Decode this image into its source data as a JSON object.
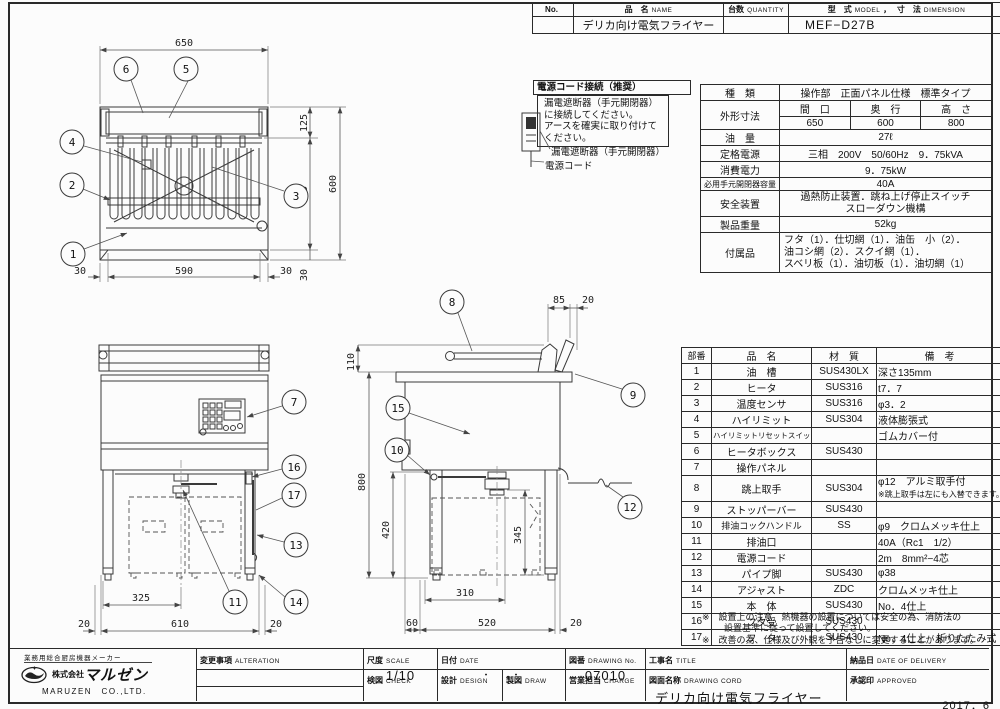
{
  "header_table": {
    "no_label": "No.",
    "name_jp": "品　名",
    "name_en": "NAME",
    "qty_jp": "台数",
    "qty_en": "QUANTITY",
    "model_jp": "型　式",
    "model_en": "MODEL",
    "comma": "，",
    "dim_jp": "寸　法",
    "dim_en": "DIMENSION",
    "product_name": "デリカ向け電気フライヤー",
    "model_value": "MEF−D27B"
  },
  "power_note": {
    "title": "電源コード接続（推奨）",
    "body1": "漏電遮断器（手元開閉器）",
    "body2": "に接続してください。",
    "body3": "アースを確実に取り付けて",
    "body4": "ください。",
    "breaker_label": "漏電遮断器（手元開閉器）",
    "cord_label": "電源コード"
  },
  "spec_table": {
    "type_label": "種　類",
    "type_value": "操作部　正面パネル仕様　標準タイプ",
    "dims_label": "外形寸法",
    "width_label": "間　口",
    "depth_label": "奥　行",
    "height_label": "高　さ",
    "width": "650",
    "depth": "600",
    "height": "800",
    "oil_label": "油　量",
    "oil": "27ℓ",
    "power_label": "定格電源",
    "power": "三相　200V　50/60Hz　9．75kVA",
    "consumption_label": "消費電力",
    "consumption": "9．75kW",
    "breaker_label": "必用手元開閉器容量",
    "breaker": "40A",
    "safety_label": "安全装置",
    "safety1": "過熱防止装置．跳ね上げ停止スイッチ",
    "safety2": "スローダウン機構",
    "weight_label": "製品重量",
    "weight": "52kg",
    "accessories_label": "付属品",
    "accessories1": "フタ（1）．仕切網（1）．油缶　小（2）．",
    "accessories2": "油コシ網（2）．スクイ網（1）．",
    "accessories3": "スベリ板（1）．油切板（1）．油切網（1）"
  },
  "parts_table": {
    "headers": {
      "no": "部番",
      "name": "品　名",
      "material": "材　質",
      "note": "備　考"
    },
    "rows": [
      {
        "no": "1",
        "name": "油　槽",
        "material": "SUS430LX",
        "note": "深さ135mm"
      },
      {
        "no": "2",
        "name": "ヒータ",
        "material": "SUS316",
        "note": "t7．7"
      },
      {
        "no": "3",
        "name": "温度センサ",
        "material": "SUS316",
        "note": "φ3．2"
      },
      {
        "no": "4",
        "name": "ハイリミット",
        "material": "SUS304",
        "note": "液体膨張式"
      },
      {
        "no": "5",
        "name": "ハイリミットリセットスイッチ",
        "material": "",
        "note": "ゴムカバー付"
      },
      {
        "no": "6",
        "name": "ヒータボックス",
        "material": "SUS430",
        "note": ""
      },
      {
        "no": "7",
        "name": "操作パネル",
        "material": "",
        "note": ""
      },
      {
        "no": "8",
        "name": "跳上取手",
        "material": "SUS304",
        "note": "φ12　アルミ取手付",
        "note2": "※跳上取手は左にも入替できます。"
      },
      {
        "no": "9",
        "name": "ストッパーバー",
        "material": "SUS430",
        "note": ""
      },
      {
        "no": "10",
        "name": "排油コックハンドル",
        "material": "SS",
        "note": "φ9　クロムメッキ仕上"
      },
      {
        "no": "11",
        "name": "排油口",
        "material": "",
        "note": "40A（Rc1　1/2）"
      },
      {
        "no": "12",
        "name": "電源コード",
        "material": "",
        "note": "2m　8mm²−4芯"
      },
      {
        "no": "13",
        "name": "パイプ脚",
        "material": "SUS430",
        "note": "φ38"
      },
      {
        "no": "14",
        "name": "アジャスト",
        "material": "ZDC",
        "note": "クロムメッキ仕上"
      },
      {
        "no": "15",
        "name": "本　体",
        "material": "SUS430",
        "note": "No．4仕上"
      },
      {
        "no": "16",
        "name": "フタ受",
        "material": "SUS430",
        "note": ""
      },
      {
        "no": "17",
        "name": "フ　タ",
        "material": "SUS430",
        "note": "No．4仕上　折りたたみ式"
      }
    ]
  },
  "notes": {
    "note1a": "※　設置上の注意　熱機器の設置については安全の為、消防法の",
    "note1b": "設置基準に従って設置してください。",
    "note2": "※　改善の為、仕様及び外観を予告なしに変更することがあります。"
  },
  "title_block": {
    "maker_tagline": "業務用総合厨房機器メーカー",
    "company_prefix": "株式会社",
    "company_jp": "マルゼン",
    "company_en": "MARUZEN　CO.,LTD.",
    "alter_jp": "変更事項",
    "alter_en": "ALTERATION",
    "scale_jp": "尺度",
    "scale_en": "SCALE",
    "scale": "1/10",
    "date_jp": "日付",
    "date_en": "DATE",
    "date": "・　　・",
    "dwgno_jp": "図番",
    "dwgno_en": "DRAWING No.",
    "dwgno": "07010",
    "title_jp": "工事名",
    "title_en": "TITLE",
    "check_jp": "検図",
    "check_en": "CHECK",
    "design_jp": "設計",
    "design_en": "DESIGN",
    "draw_jp": "製図",
    "draw_en": "DRAW",
    "charge_jp": "営業担当",
    "charge_en": "CHARGE",
    "dwgname_jp": "図面名称",
    "dwgname_en": "DRAWING CORD",
    "dwgname": "デリカ向け電気フライヤー",
    "delivery_jp": "納品日",
    "delivery_en": "DATE OF DELIVERY",
    "approved_jp": "承認印",
    "approved_en": "APPROVED",
    "issue_date": "2017．6"
  },
  "views": {
    "top": {
      "dims": {
        "overall_w": "650",
        "lid": "125",
        "tank": "445",
        "overall_d": "600",
        "lip": "30",
        "edge_l": "30",
        "inner": "590",
        "edge_r": "30"
      },
      "callouts": {
        "oil_tank": "1",
        "heater": "2",
        "sensor": "3",
        "high_limit": "4",
        "reset": "5",
        "box": "6"
      }
    },
    "front": {
      "dims": {
        "half": "325",
        "left": "20",
        "span": "610",
        "right": "20"
      },
      "callouts": {
        "panel": "7",
        "lid_rest": "16",
        "stopper": "17",
        "leg": "13",
        "drain": "11",
        "adjuster": "14"
      }
    },
    "side": {
      "dims": {
        "handle": "110",
        "overall_h": "800",
        "under": "420",
        "clear": "345",
        "back": "85",
        "back2": "20",
        "can": "310",
        "front": "60",
        "span": "520",
        "rear": "20"
      },
      "callouts": {
        "handle": "8",
        "lid": "9",
        "body": "15",
        "cock": "10",
        "cord": "12"
      }
    }
  }
}
